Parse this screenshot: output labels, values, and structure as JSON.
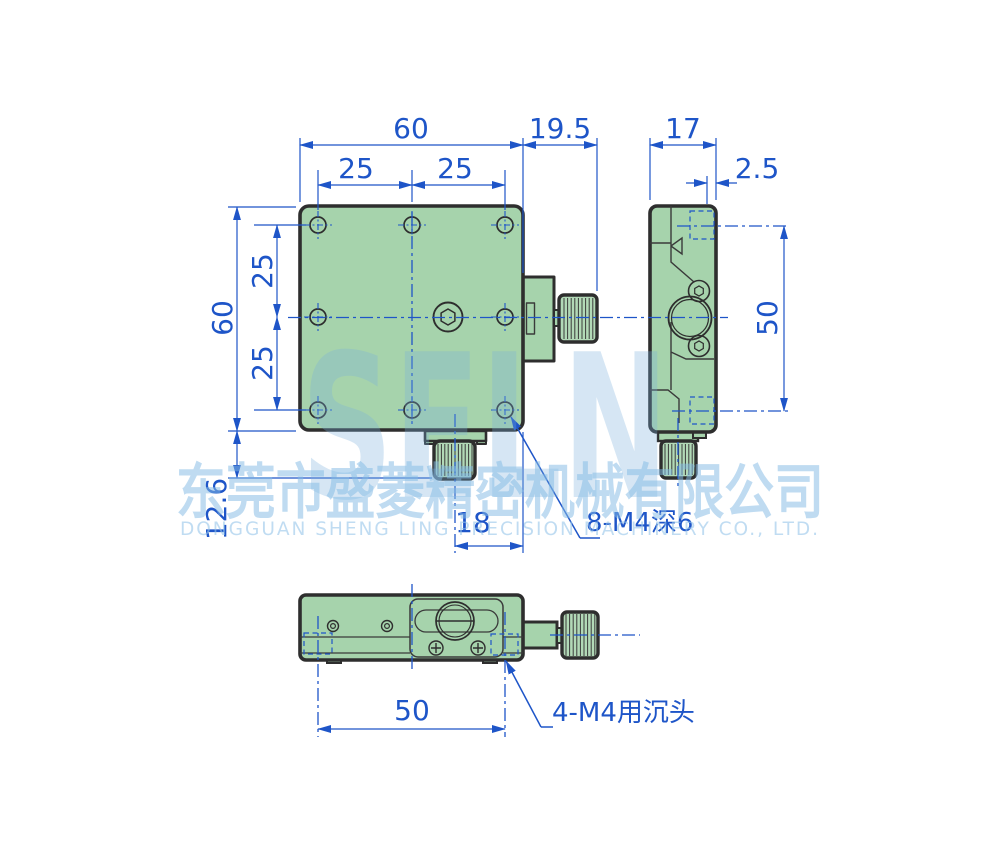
{
  "dimensions": {
    "top_width": "60",
    "top_pitch_left": "25",
    "top_pitch_right": "25",
    "knob_protrusion": "19.5",
    "side_width": "17",
    "side_step": "2.5",
    "side_height": "50",
    "left_height": "60",
    "left_pitch_top": "25",
    "left_pitch_bottom": "25",
    "bottom_knob_height": "12.6",
    "knob_axis_offset": "18",
    "bottom_hole_span": "50"
  },
  "annotations": {
    "thread_callout": "8-M4深6",
    "counterbore_callout": "4-M4用沉头"
  },
  "watermark": {
    "logo": "SELN",
    "company_cn": "东莞市盛菱精密机械有限公司",
    "company_en": "DONGGUAN SHENG LING PRECISION MACHINERY CO., LTD."
  },
  "colors": {
    "part_fill": "#a6d3ac",
    "outline": "#2e2e2e",
    "dimension_blue": "#1e55c8",
    "watermark_blue": "#85bce6",
    "background": "#ffffff"
  }
}
